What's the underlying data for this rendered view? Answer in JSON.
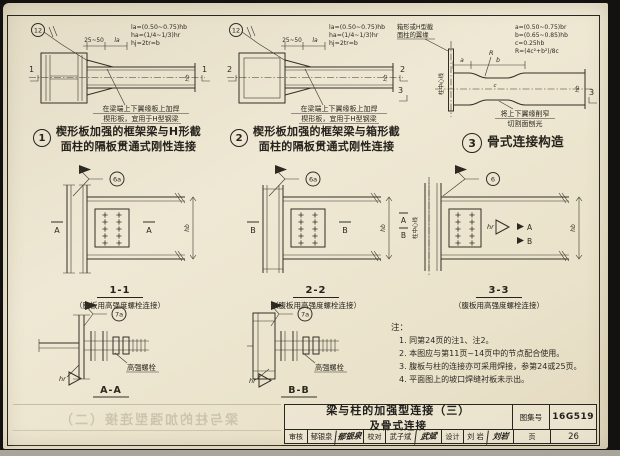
{
  "doc": {
    "bleed_title": "梁与柱的加强型连接（二）"
  },
  "d1": {
    "weld_ref": "12",
    "dim1": "25~50",
    "dim2": "la",
    "f1": "la=(0.50~0.75)hb",
    "f2": "ha=(1/4~1/3)hr",
    "f3": "hj=2tr=b",
    "hb": "hb",
    "mark": "1",
    "note1": "在梁端上下翼缘板上加焊",
    "note2": "楔形板，宜用于H型钢梁",
    "num": "1",
    "cap1": "楔形板加强的框架梁与H形截",
    "cap2": "面柱的隔板贯通式刚性连接"
  },
  "d2": {
    "weld_ref": "12",
    "dim1": "25~50",
    "dim2": "la",
    "f1": "la=(0.50~0.75)hb",
    "f2": "ha=(1/4~1/3)hr",
    "f3": "hj=2tr=b",
    "hb": "hb",
    "mark": "2",
    "note1": "在梁端上下翼缘板上加焊",
    "note2": "楔形板，宜用于H型钢梁",
    "num": "2",
    "cap1": "楔形板加强的框架梁与箱形截",
    "cap2": "面柱的隔板贯通式刚性连接"
  },
  "d3": {
    "flange1": "箱形或H型截",
    "flange2": "面柱的翼缘",
    "axis": "柱中心线",
    "dim_a": "a",
    "dim_b": "b",
    "dim_c": "c",
    "r_label": "R",
    "f1": "a=(0.50~0.75)br",
    "f2": "b=(0.65~0.85)hb",
    "f3": "c=0.25hb",
    "f4": "R=(4c²+b²)/8c",
    "hb": "hb",
    "mark": "3",
    "note1": "将上下翼缘削窄",
    "note2": "切割面刨光",
    "num": "3",
    "cap1": "骨式连接构造"
  },
  "s11": {
    "weld_ref": "6a",
    "mark": "A",
    "hb": "hb",
    "title": "1-1",
    "sub": "（腹板用高强度螺栓连接）"
  },
  "s22": {
    "weld_ref": "6a",
    "mark": "B",
    "hb": "hb",
    "title": "2-2",
    "sub": "（腹板用高强度螺栓连接）"
  },
  "s33": {
    "weld_ref": "6",
    "axis": "柱中心线",
    "markA": "A",
    "markB": "B",
    "hr": "hr",
    "hb": "hb",
    "title": "3-3",
    "sub": "（腹板用高强度螺栓连接）"
  },
  "aa": {
    "weld_ref": "7a",
    "bolt": "高强螺栓",
    "hr": "hr",
    "title": "A-A"
  },
  "bb": {
    "weld_ref": "7a",
    "bolt": "高强螺栓",
    "hr": "hr",
    "title": "B-B"
  },
  "notes": {
    "head": "注：",
    "items": [
      "1. 同第24页的注1、注2。",
      "2. 本图应与第11页~14页中的节点配合使用。",
      "3. 腹板与柱的连接亦可采用焊接，参第24或25页。",
      "4. 平面图上的坡口焊缝衬板未示出。"
    ]
  },
  "titleblock": {
    "title1": "梁与柱的加强型连接（三）",
    "title2": "及骨式连接",
    "atlas_label": "图集号",
    "atlas_no": "16G519",
    "page_label": "页",
    "page_no": "26",
    "c1_label": "审核",
    "c1_name": "郁银泉",
    "c1_sig": "郁银泉",
    "c2_label": "校对",
    "c2_name": "武子斌",
    "c2_sig": "武斌",
    "c3_label": "设计",
    "c3_name": "刘 岩",
    "c3_sig": "刘岩"
  }
}
